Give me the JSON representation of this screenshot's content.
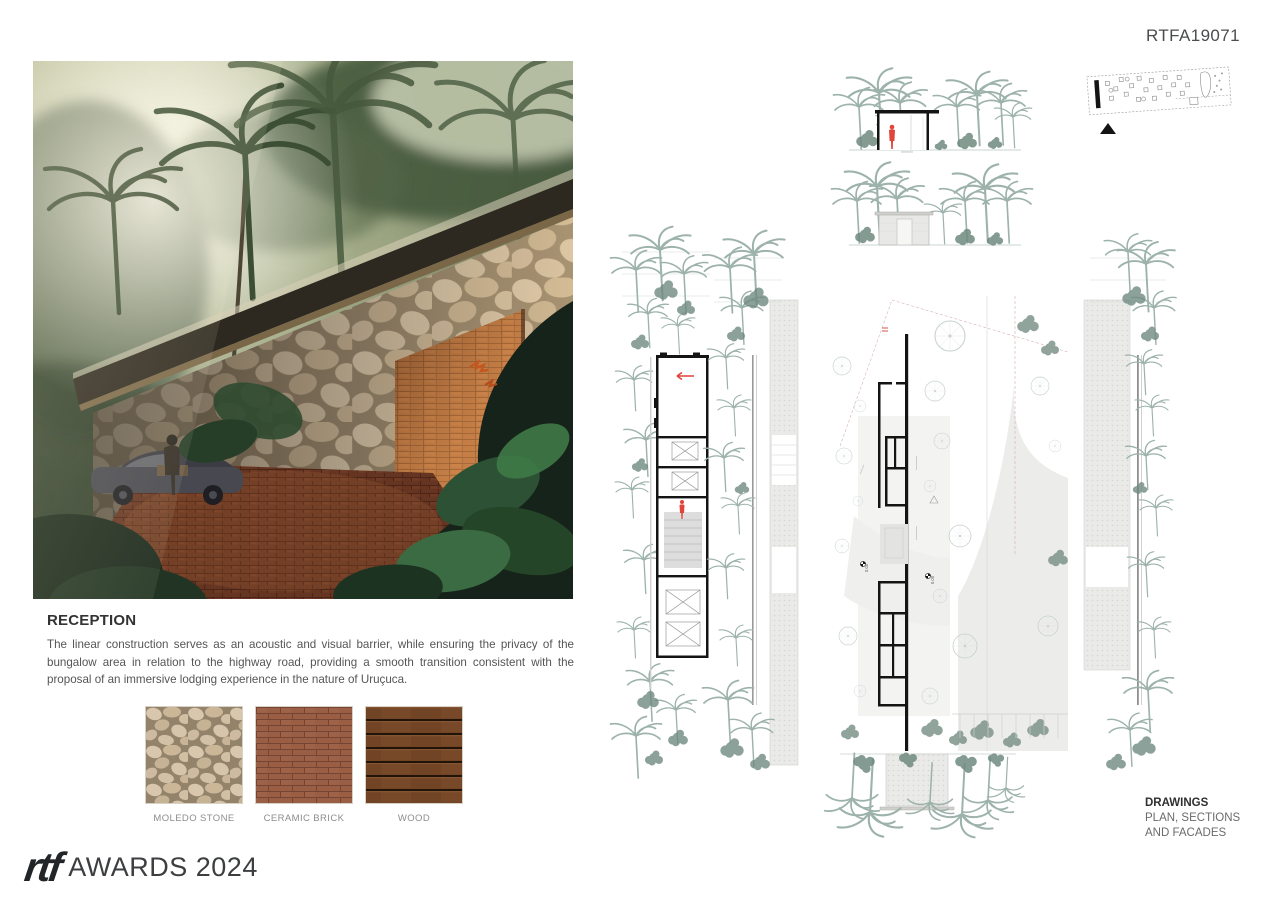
{
  "board": {
    "code": "RTFA19071"
  },
  "reception": {
    "title": "RECEPTION",
    "body": "The linear construction serves as an acoustic and visual barrier, while ensuring the privacy of the bungalow area in relation to the highway road, providing a smooth transition consistent with the proposal of an immersive lodging experience in the nature of Uruçuca."
  },
  "materials": {
    "items": [
      {
        "label": "MOLEDO STONE"
      },
      {
        "label": "CERAMIC BRICK"
      },
      {
        "label": "WOOD"
      }
    ]
  },
  "footer": {
    "logo_text": "rtf",
    "awards_text": "AWARDS 2024"
  },
  "drawings": {
    "title": "DRAWINGS",
    "subtitle_line1": "PLAN, SECTIONS",
    "subtitle_line2": "AND FACADES",
    "level_annotations": [
      "0.00",
      "0.00"
    ]
  },
  "colors": {
    "accent_red": "#e0443a",
    "linework": "#9db3ac",
    "linework_dark": "#6f8a80",
    "wall_black": "#141414"
  }
}
